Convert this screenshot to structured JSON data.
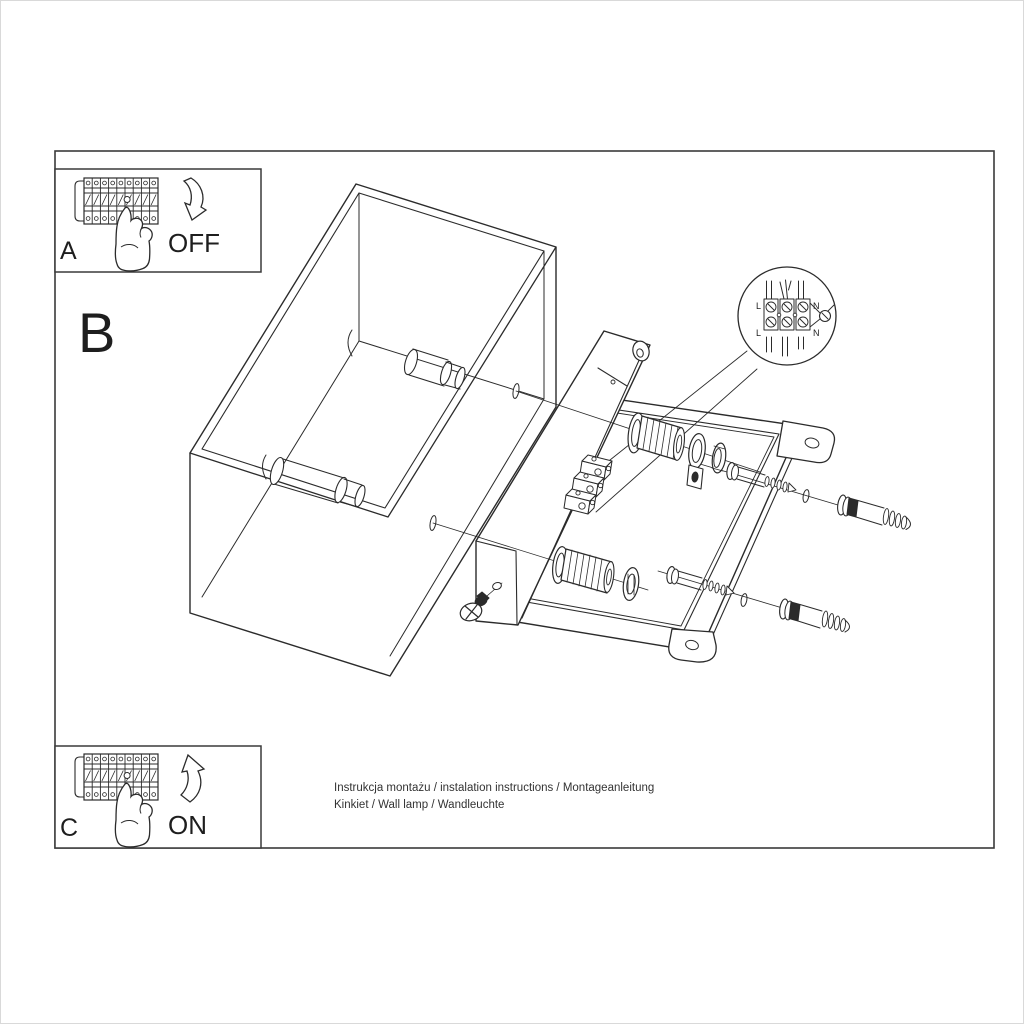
{
  "page": {
    "background": "#ffffff",
    "ink": "#2b2b2b",
    "frame_color": "#3a3a3a"
  },
  "steps": {
    "a": {
      "label": "A",
      "action": "OFF"
    },
    "b": {
      "label": "B"
    },
    "c": {
      "label": "C",
      "action": "ON"
    }
  },
  "wiring_detail": {
    "l_top": "L",
    "n_top": "N",
    "l_bottom": "L",
    "n_bottom": "N"
  },
  "footer": {
    "line1": "Instrukcja montażu / instalation instructions / Montageanleitung",
    "line2": "Kinkiet / Wall lamp / Wandleuchte"
  }
}
